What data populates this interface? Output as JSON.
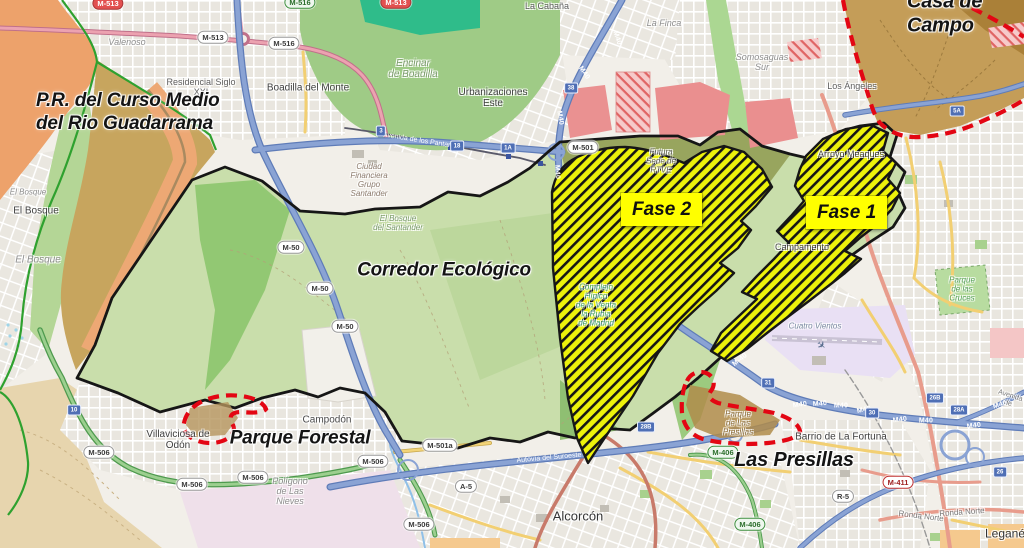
{
  "annotations": {
    "pr_guadarrama": "P.R. del Curso Medio\ndel Rio Guadarrama",
    "corredor": "Corredor Ecológico",
    "casa_de_campo": "Casa de Campo",
    "parque_forestal": "Parque Forestal",
    "las_presillas": "Las Presillas",
    "fase1": "Fase 1",
    "fase2": "Fase 2"
  },
  "places": [
    {
      "t": "Valenoso",
      "x": 127,
      "y": 42,
      "fs": 9,
      "i": 1,
      "c": "#8e8e8e"
    },
    {
      "t": "Residencial Siglo\nXXI",
      "x": 201,
      "y": 87,
      "fs": 9,
      "c": "#5f5f5f"
    },
    {
      "t": "Boadilla del Monte",
      "x": 308,
      "y": 88,
      "fs": 10,
      "c": "#3f3f3f"
    },
    {
      "t": "La Cabaña",
      "x": 547,
      "y": 6,
      "fs": 9,
      "c": "#5f5f5f"
    },
    {
      "t": "La Finca",
      "x": 664,
      "y": 23,
      "fs": 9,
      "i": 1,
      "c": "#8e8e8e"
    },
    {
      "t": "Encinar\nde Boadilla",
      "x": 413,
      "y": 69,
      "fs": 10,
      "i": 1,
      "c": "#7b9c6b"
    },
    {
      "t": "Urbanizaciones\nEste",
      "x": 493,
      "y": 98,
      "fs": 10,
      "c": "#3f3f3f"
    },
    {
      "t": "Somosaguas\nSur",
      "x": 762,
      "y": 62,
      "fs": 9,
      "i": 1,
      "c": "#8e8e8e"
    },
    {
      "t": "Los Ángeles",
      "x": 852,
      "y": 86,
      "fs": 9,
      "c": "#5f5f5f"
    },
    {
      "t": "Arroyo Meaques",
      "x": 851,
      "y": 154,
      "fs": 9,
      "c": "#4a4a4a"
    },
    {
      "t": "El Bosque",
      "x": 28,
      "y": 193,
      "fs": 8,
      "i": 1,
      "c": "#8e8e8e"
    },
    {
      "t": "El Bosque",
      "x": 36,
      "y": 211,
      "fs": 10,
      "c": "#3f3f3f"
    },
    {
      "t": "El Bosque",
      "x": 38,
      "y": 260,
      "fs": 10,
      "i": 1,
      "c": "#8e8e8e"
    },
    {
      "t": "Ciudad\nFinanciera\nGrupo\nSantander",
      "x": 369,
      "y": 181,
      "fs": 8,
      "i": 1,
      "c": "#8c7b6d"
    },
    {
      "t": "El Bosque\ndel Santander",
      "x": 398,
      "y": 224,
      "fs": 8,
      "i": 1,
      "c": "#7b9c6b"
    },
    {
      "t": "Futura\nSede de\nRTVE",
      "x": 661,
      "y": 162,
      "fs": 8,
      "i": 1,
      "c": "#63635a"
    },
    {
      "t": "Complejo\nHípico\nde la Venta\nla Rubia\nde Madrid",
      "x": 596,
      "y": 306,
      "fs": 8,
      "i": 1,
      "c": "#3f9e78"
    },
    {
      "t": "Campodón",
      "x": 327,
      "y": 420,
      "fs": 10,
      "c": "#4a4a4a"
    },
    {
      "t": "Villaviciosa de\nOdón",
      "x": 178,
      "y": 440,
      "fs": 10,
      "c": "#3f3f3f"
    },
    {
      "t": "Polígono\nde Las\nNieves",
      "x": 290,
      "y": 491,
      "fs": 9,
      "i": 1,
      "c": "#8e8e8e"
    },
    {
      "t": "Alcorcón",
      "x": 578,
      "y": 517,
      "fs": 13,
      "c": "#333333"
    },
    {
      "t": "Cuatro Vientos",
      "x": 815,
      "y": 327,
      "fs": 8,
      "i": 1,
      "c": "#7a8aa0"
    },
    {
      "t": "Barrio de La Fortuna",
      "x": 841,
      "y": 437,
      "fs": 10,
      "c": "#3f3f3f"
    },
    {
      "t": "Parque\nde las\nCruces",
      "x": 962,
      "y": 290,
      "fs": 8,
      "i": 1,
      "c": "#55a055"
    },
    {
      "t": "Parque\nde Las\nPresillas",
      "x": 738,
      "y": 424,
      "fs": 8,
      "i": 1,
      "c": "#8a6d3b"
    },
    {
      "t": "Campamento",
      "x": 802,
      "y": 247,
      "fs": 9,
      "c": "#4a4a4a"
    },
    {
      "t": "Leganés",
      "x": 1008,
      "y": 534,
      "fs": 12,
      "c": "#333333"
    },
    {
      "t": "Ronda Norte",
      "x": 921,
      "y": 517,
      "fs": 8,
      "rot": 7,
      "c": "#7a7a7a"
    },
    {
      "t": "Ronda Norte",
      "x": 962,
      "y": 513,
      "fs": 8,
      "rot": -4,
      "c": "#7a7a7a"
    },
    {
      "t": "Avenida de",
      "x": 1009,
      "y": 400,
      "fs": 7,
      "rot": 18,
      "c": "#7a7a7a"
    }
  ],
  "road_shields": [
    {
      "t": "M-513",
      "x": 108,
      "y": 3,
      "cls": "sh-r"
    },
    {
      "t": "M-516",
      "x": 300,
      "y": 2,
      "cls": "sh-g"
    },
    {
      "t": "M-513",
      "x": 396,
      "y": 2,
      "cls": "sh-r"
    },
    {
      "t": "M-513",
      "x": 213,
      "y": 37
    },
    {
      "t": "M-516",
      "x": 284,
      "y": 43
    },
    {
      "t": "M-50",
      "x": 291,
      "y": 247
    },
    {
      "t": "M-50",
      "x": 320,
      "y": 288
    },
    {
      "t": "M-50",
      "x": 345,
      "y": 326
    },
    {
      "t": "M-501",
      "x": 583,
      "y": 147
    },
    {
      "t": "M-506",
      "x": 99,
      "y": 452
    },
    {
      "t": "M-506",
      "x": 192,
      "y": 484
    },
    {
      "t": "M-506",
      "x": 253,
      "y": 477
    },
    {
      "t": "M-506",
      "x": 373,
      "y": 461
    },
    {
      "t": "M-506",
      "x": 419,
      "y": 524
    },
    {
      "t": "M-501a",
      "x": 440,
      "y": 445
    },
    {
      "t": "A-5",
      "x": 466,
      "y": 486
    },
    {
      "t": "M-406",
      "x": 723,
      "y": 452,
      "cls": "sh-g"
    },
    {
      "t": "M-406",
      "x": 750,
      "y": 524,
      "cls": "sh-g"
    },
    {
      "t": "M-411",
      "x": 898,
      "y": 482,
      "cls": "sh-rb"
    },
    {
      "t": "R-5",
      "x": 843,
      "y": 496
    }
  ],
  "exit_badges": [
    {
      "t": "38",
      "x": 571,
      "y": 88
    },
    {
      "t": "3",
      "x": 381,
      "y": 131
    },
    {
      "t": "18",
      "x": 457,
      "y": 146
    },
    {
      "t": "1A",
      "x": 508,
      "y": 148
    },
    {
      "t": "31",
      "x": 768,
      "y": 383
    },
    {
      "t": "30",
      "x": 872,
      "y": 413
    },
    {
      "t": "26B",
      "x": 935,
      "y": 398
    },
    {
      "t": "28A",
      "x": 959,
      "y": 410
    },
    {
      "t": "26",
      "x": 1000,
      "y": 472
    },
    {
      "t": "28B",
      "x": 646,
      "y": 427
    },
    {
      "t": "10",
      "x": 74,
      "y": 410
    },
    {
      "t": "5A",
      "x": 957,
      "y": 111
    }
  ],
  "motorway_labels": [
    {
      "t": "M40",
      "x": 617,
      "y": 38,
      "rot": 72
    },
    {
      "t": "M40",
      "x": 584,
      "y": 73,
      "rot": 55
    },
    {
      "t": "M40",
      "x": 560,
      "y": 118,
      "rot": 80
    },
    {
      "t": "M40",
      "x": 557,
      "y": 172,
      "rot": 87
    },
    {
      "t": "M-40",
      "x": 740,
      "y": 360,
      "rot": -38
    },
    {
      "t": "M40",
      "x": 800,
      "y": 405,
      "rot": -8
    },
    {
      "t": "M40",
      "x": 820,
      "y": 404,
      "rot": -5
    },
    {
      "t": "M40",
      "x": 841,
      "y": 406
    },
    {
      "t": "M40",
      "x": 864,
      "y": 410,
      "rot": -12
    },
    {
      "t": "M40",
      "x": 900,
      "y": 420,
      "rot": -8
    },
    {
      "t": "M40",
      "x": 926,
      "y": 421
    },
    {
      "t": "M40",
      "x": 974,
      "y": 426,
      "rot": -8
    },
    {
      "t": "M40",
      "x": 1000,
      "y": 405,
      "rot": -18
    }
  ],
  "road_name_labels": [
    {
      "t": "Avenida de los Pantanos",
      "x": 421,
      "y": 141,
      "rot": 9
    },
    {
      "t": "Autovía del Suroeste",
      "x": 549,
      "y": 458,
      "rot": -5
    }
  ],
  "colors": {
    "fase_fill_yellow": "#edf20b",
    "fase_hatch_black": "#161616",
    "boundary_black": "#161616",
    "pr_boundary_green": "#2fa12f",
    "protected_dash_red": "#e30613",
    "corridor_green": "#c9deab",
    "forest_green": "#9fcb86",
    "terrain_tan": "#c7a55e",
    "terrain_orange": "#eda26b",
    "casa_de_campo_tan": "#c49d58",
    "motorway_blue": "#8aa3d4",
    "label_box_yellow": "#ffff00"
  }
}
